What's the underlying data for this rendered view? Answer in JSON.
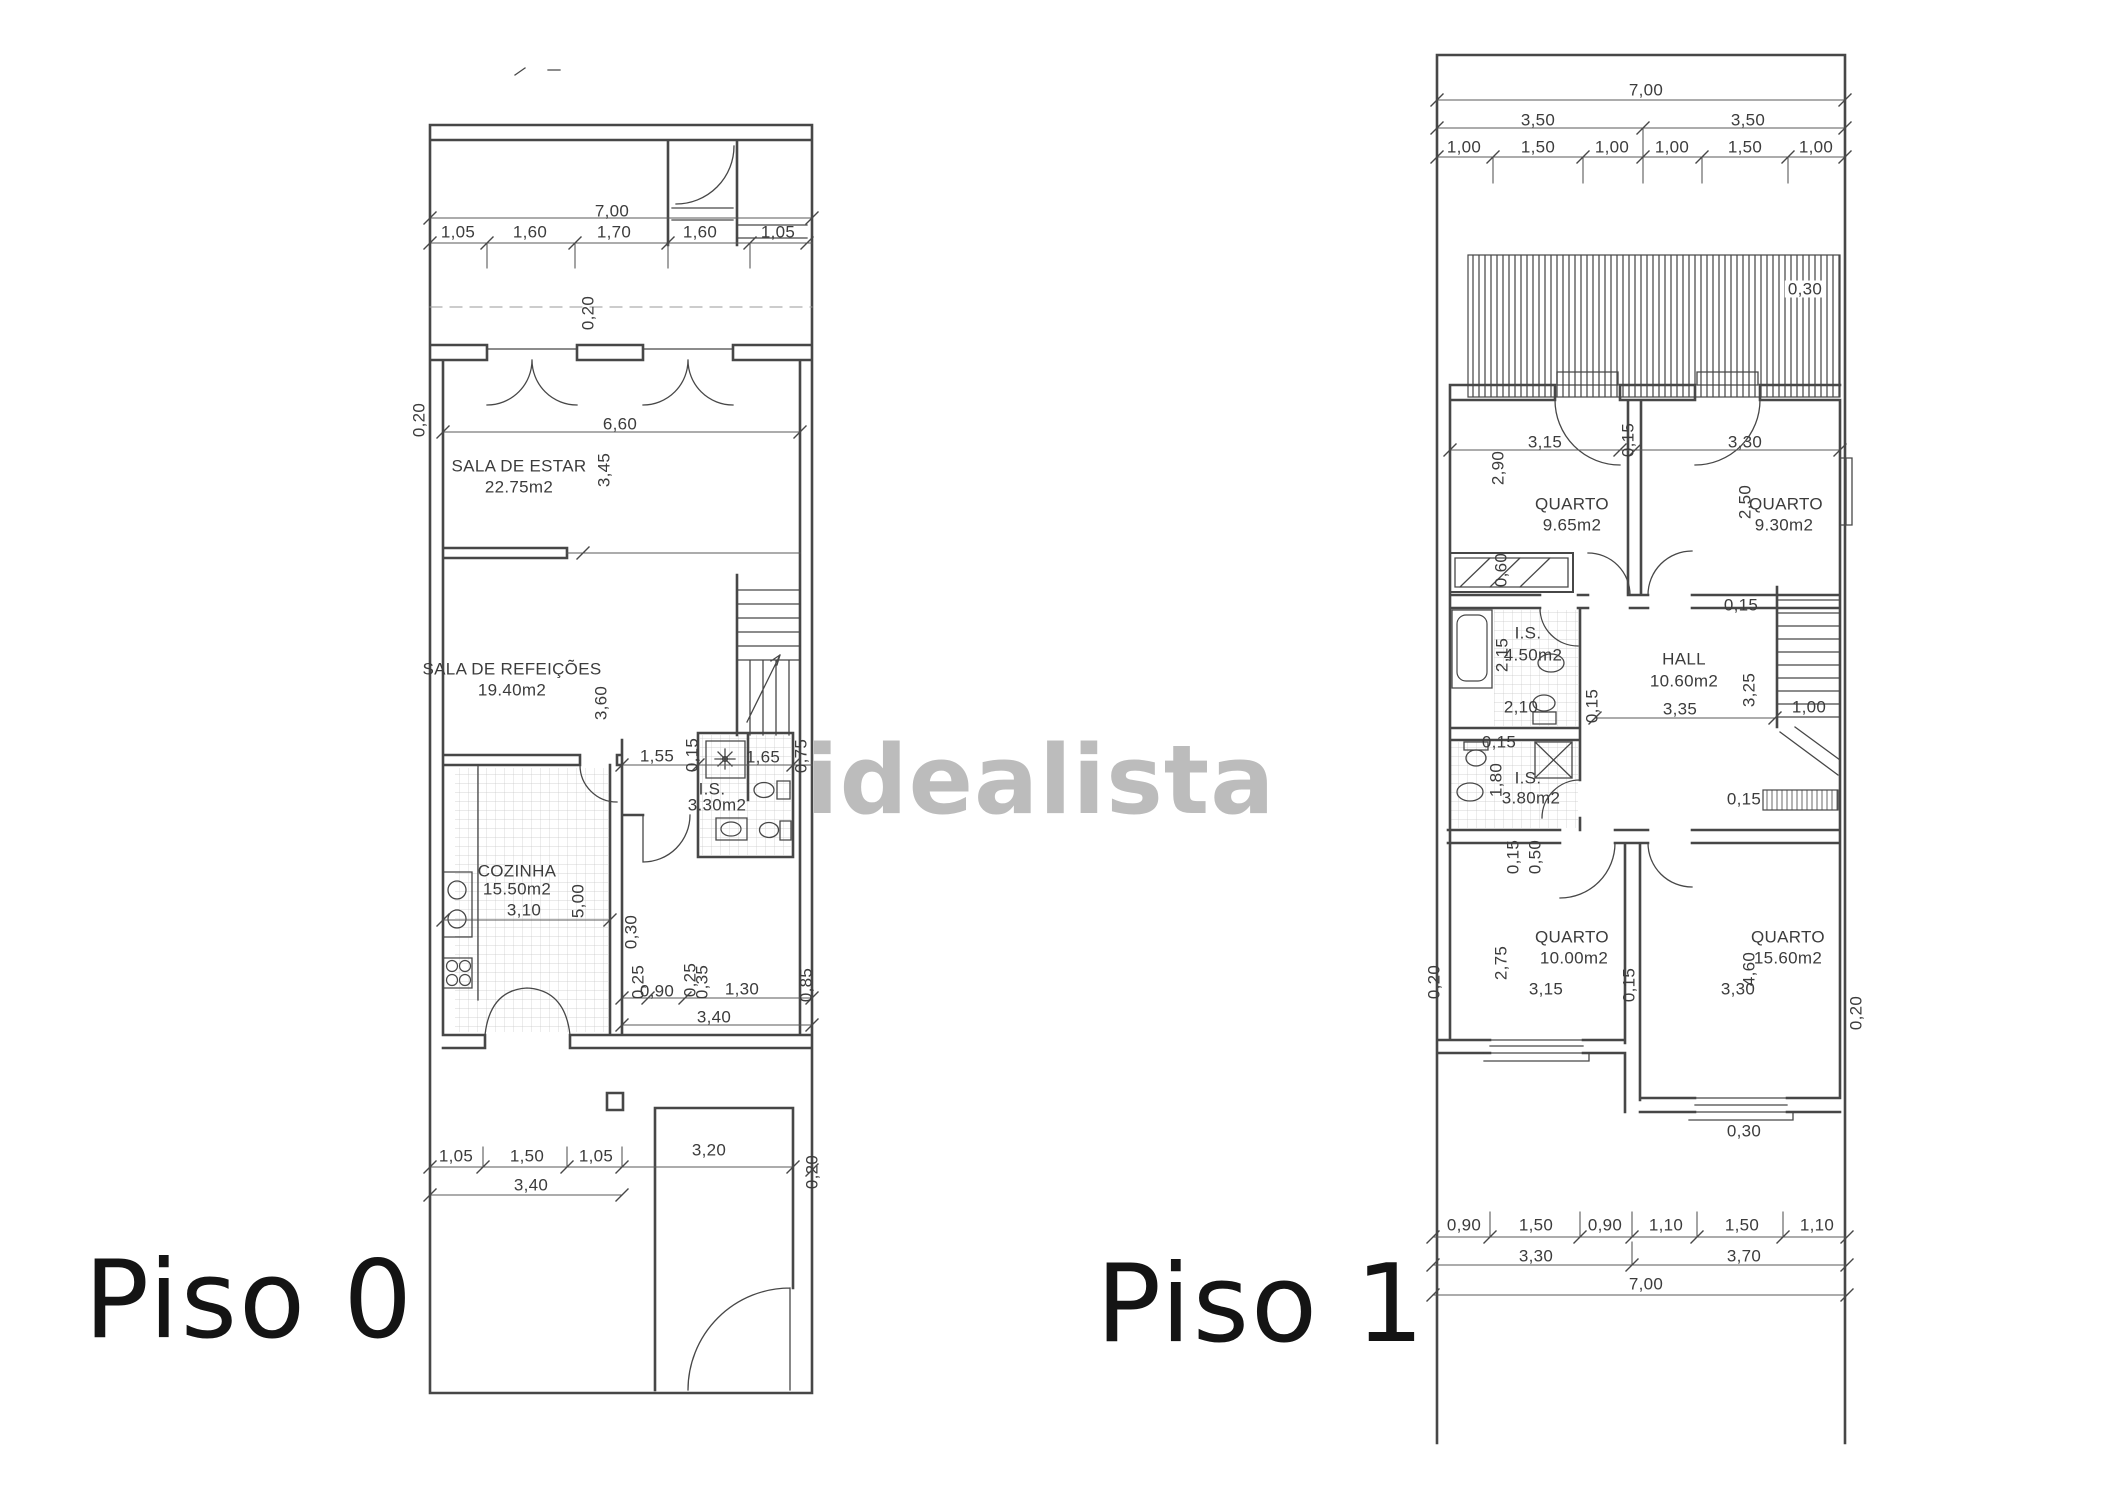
{
  "watermark": {
    "text": "idealista",
    "color": "#a8a8a8"
  },
  "colors": {
    "line": "#474747",
    "dim_line": "#5a5a5a",
    "text": "#3c3c3c",
    "background": "#ffffff"
  },
  "plans": {
    "piso0": {
      "name": "Piso 0",
      "rooms": [
        {
          "name": "SALA DE ESTAR",
          "area": "22.75m2"
        },
        {
          "name": "SALA DE REFEIÇÕES",
          "area": "19.40m2"
        },
        {
          "name": "COZINHA",
          "area": "15.50m2"
        },
        {
          "name": "I.S.",
          "area": "3.30m2"
        }
      ],
      "labels": [
        {
          "t": "7,00",
          "x": 612,
          "y": 211
        },
        {
          "t": "1,05",
          "x": 458,
          "y": 232
        },
        {
          "t": "1,60",
          "x": 530,
          "y": 232
        },
        {
          "t": "1,70",
          "x": 614,
          "y": 232
        },
        {
          "t": "1,60",
          "x": 700,
          "y": 232
        },
        {
          "t": "1,05",
          "x": 778,
          "y": 232
        },
        {
          "t": "0,20",
          "x": 419,
          "y": 420,
          "r": 1
        },
        {
          "t": "0,20",
          "x": 588,
          "y": 313,
          "r": 1
        },
        {
          "t": "6,60",
          "x": 620,
          "y": 424
        },
        {
          "t": "SALA DE ESTAR",
          "x": 519,
          "y": 466,
          "n": "room-label"
        },
        {
          "t": "22.75m2",
          "x": 519,
          "y": 487,
          "n": "room-area"
        },
        {
          "t": "3,45",
          "x": 604,
          "y": 470,
          "r": 1
        },
        {
          "t": "SALA DE REFEIÇÕES",
          "x": 512,
          "y": 669,
          "n": "room-label"
        },
        {
          "t": "19.40m2",
          "x": 512,
          "y": 690,
          "n": "room-area"
        },
        {
          "t": "3,60",
          "x": 601,
          "y": 703,
          "r": 1
        },
        {
          "t": "1,55",
          "x": 657,
          "y": 756
        },
        {
          "t": "0,15",
          "x": 692,
          "y": 755,
          "r": 1
        },
        {
          "t": "1,65",
          "x": 763,
          "y": 757
        },
        {
          "t": "0,75",
          "x": 801,
          "y": 756,
          "r": 1
        },
        {
          "t": "I.S.",
          "x": 712,
          "y": 789,
          "n": "room-label"
        },
        {
          "t": "3.30m2",
          "x": 717,
          "y": 805,
          "n": "room-area"
        },
        {
          "t": "COZINHA",
          "x": 517,
          "y": 871,
          "n": "room-label"
        },
        {
          "t": "15.50m2",
          "x": 517,
          "y": 889,
          "n": "room-area"
        },
        {
          "t": "3,10",
          "x": 524,
          "y": 910
        },
        {
          "t": "5,00",
          "x": 578,
          "y": 901,
          "r": 1
        },
        {
          "t": "0,30",
          "x": 631,
          "y": 932,
          "r": 1
        },
        {
          "t": "0,25",
          "x": 638,
          "y": 982,
          "r": 1
        },
        {
          "t": "0,90",
          "x": 657,
          "y": 991
        },
        {
          "t": "0,25",
          "x": 690,
          "y": 980,
          "r": 1
        },
        {
          "t": "0,35",
          "x": 702,
          "y": 982,
          "r": 1
        },
        {
          "t": "1,30",
          "x": 742,
          "y": 989
        },
        {
          "t": "0,85",
          "x": 806,
          "y": 985,
          "r": 1
        },
        {
          "t": "3,40",
          "x": 714,
          "y": 1017
        },
        {
          "t": "1,05",
          "x": 456,
          "y": 1156
        },
        {
          "t": "1,50",
          "x": 527,
          "y": 1156
        },
        {
          "t": "1,05",
          "x": 596,
          "y": 1156
        },
        {
          "t": "3,20",
          "x": 709,
          "y": 1150
        },
        {
          "t": "3,40",
          "x": 531,
          "y": 1185
        },
        {
          "t": "0,20",
          "x": 812,
          "y": 1172,
          "r": 1
        }
      ]
    },
    "piso1": {
      "name": "Piso 1",
      "rooms": [
        {
          "name": "QUARTO",
          "area": "9.65m2"
        },
        {
          "name": "QUARTO",
          "area": "9.30m2"
        },
        {
          "name": "I.S.",
          "area": "4.50m2"
        },
        {
          "name": "HALL",
          "area": "10.60m2"
        },
        {
          "name": "I.S.",
          "area": "3.80m2"
        },
        {
          "name": "QUARTO",
          "area": "10.00m2"
        },
        {
          "name": "QUARTO",
          "area": "15.60m2"
        }
      ],
      "labels": [
        {
          "t": "7,00",
          "x": 1646,
          "y": 90
        },
        {
          "t": "3,50",
          "x": 1538,
          "y": 120
        },
        {
          "t": "3,50",
          "x": 1748,
          "y": 120
        },
        {
          "t": "1,00",
          "x": 1464,
          "y": 147
        },
        {
          "t": "1,50",
          "x": 1538,
          "y": 147
        },
        {
          "t": "1,00",
          "x": 1612,
          "y": 147
        },
        {
          "t": "1,00",
          "x": 1672,
          "y": 147
        },
        {
          "t": "1,50",
          "x": 1745,
          "y": 147
        },
        {
          "t": "1,00",
          "x": 1816,
          "y": 147
        },
        {
          "t": "0,30",
          "x": 1805,
          "y": 289,
          "w": 1
        },
        {
          "t": "3,15",
          "x": 1545,
          "y": 442
        },
        {
          "t": "0,15",
          "x": 1628,
          "y": 440,
          "r": 1
        },
        {
          "t": "3,30",
          "x": 1745,
          "y": 442
        },
        {
          "t": "2,90",
          "x": 1498,
          "y": 468,
          "r": 1
        },
        {
          "t": "QUARTO",
          "x": 1572,
          "y": 504,
          "n": "room-label"
        },
        {
          "t": "9.65m2",
          "x": 1572,
          "y": 525,
          "n": "room-area"
        },
        {
          "t": "2,50",
          "x": 1745,
          "y": 502,
          "r": 1
        },
        {
          "t": "QUARTO",
          "x": 1786,
          "y": 504,
          "n": "room-label"
        },
        {
          "t": "9.30m2",
          "x": 1784,
          "y": 525,
          "n": "room-area"
        },
        {
          "t": "0,60",
          "x": 1501,
          "y": 570,
          "r": 1
        },
        {
          "t": "2,15",
          "x": 1502,
          "y": 655,
          "r": 1
        },
        {
          "t": "I.S.",
          "x": 1528,
          "y": 633,
          "n": "room-label"
        },
        {
          "t": "4.50m2",
          "x": 1533,
          "y": 655,
          "n": "room-area"
        },
        {
          "t": "2,10",
          "x": 1521,
          "y": 707
        },
        {
          "t": "0,15",
          "x": 1592,
          "y": 706,
          "r": 1
        },
        {
          "t": "HALL",
          "x": 1684,
          "y": 659,
          "n": "room-label"
        },
        {
          "t": "10.60m2",
          "x": 1684,
          "y": 681,
          "n": "room-area"
        },
        {
          "t": "3,35",
          "x": 1680,
          "y": 709
        },
        {
          "t": "3,25",
          "x": 1749,
          "y": 690,
          "r": 1
        },
        {
          "t": "0,15",
          "x": 1741,
          "y": 605
        },
        {
          "t": "1,00",
          "x": 1809,
          "y": 707
        },
        {
          "t": "0,15",
          "x": 1499,
          "y": 742
        },
        {
          "t": "1,80",
          "x": 1496,
          "y": 780,
          "r": 1
        },
        {
          "t": "I.S.",
          "x": 1528,
          "y": 778,
          "n": "room-label"
        },
        {
          "t": "3.80m2",
          "x": 1531,
          "y": 798,
          "n": "room-area"
        },
        {
          "t": "0,15",
          "x": 1513,
          "y": 857,
          "r": 1
        },
        {
          "t": "0,50",
          "x": 1535,
          "y": 857,
          "r": 1
        },
        {
          "t": "0,15",
          "x": 1744,
          "y": 799
        },
        {
          "t": "QUARTO",
          "x": 1572,
          "y": 937,
          "n": "room-label"
        },
        {
          "t": "10.00m2",
          "x": 1574,
          "y": 958,
          "n": "room-area"
        },
        {
          "t": "2,75",
          "x": 1501,
          "y": 963,
          "r": 1
        },
        {
          "t": "3,15",
          "x": 1546,
          "y": 989
        },
        {
          "t": "0,15",
          "x": 1629,
          "y": 985,
          "r": 1
        },
        {
          "t": "QUARTO",
          "x": 1788,
          "y": 937,
          "n": "room-label"
        },
        {
          "t": "15.60m2",
          "x": 1788,
          "y": 958,
          "n": "room-area"
        },
        {
          "t": "4,60",
          "x": 1749,
          "y": 969,
          "r": 1
        },
        {
          "t": "3,30",
          "x": 1738,
          "y": 989
        },
        {
          "t": "0,20",
          "x": 1856,
          "y": 1013,
          "r": 1
        },
        {
          "t": "0,20",
          "x": 1434,
          "y": 982,
          "r": 1
        },
        {
          "t": "0,30",
          "x": 1744,
          "y": 1131
        },
        {
          "t": "0,90",
          "x": 1464,
          "y": 1225
        },
        {
          "t": "1,50",
          "x": 1536,
          "y": 1225
        },
        {
          "t": "0,90",
          "x": 1605,
          "y": 1225
        },
        {
          "t": "1,10",
          "x": 1666,
          "y": 1225
        },
        {
          "t": "1,50",
          "x": 1742,
          "y": 1225
        },
        {
          "t": "1,10",
          "x": 1817,
          "y": 1225
        },
        {
          "t": "3,30",
          "x": 1536,
          "y": 1256
        },
        {
          "t": "3,70",
          "x": 1744,
          "y": 1256
        },
        {
          "t": "7,00",
          "x": 1646,
          "y": 1284
        }
      ]
    }
  }
}
